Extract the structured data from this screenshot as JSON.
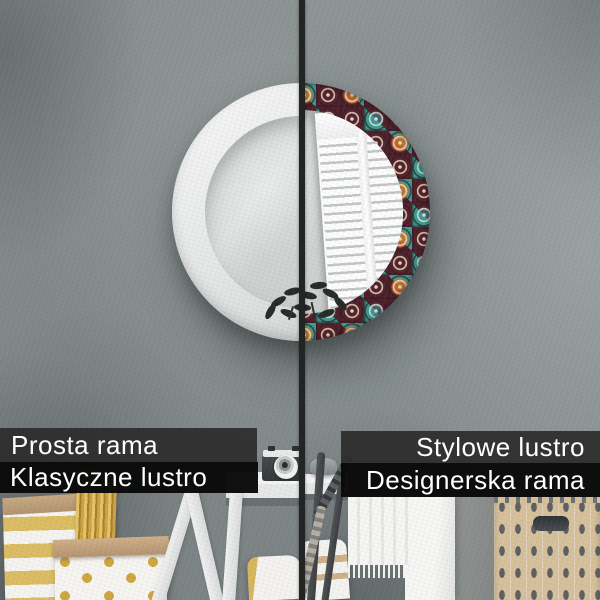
{
  "image": {
    "kind": "product-comparison-photo",
    "subject": "round decorative wall mirror, plain frame vs designer mosaic frame",
    "width": 600,
    "height": 600
  },
  "captions": {
    "left": {
      "line1": "Prosta rama",
      "line2": "Klasyczne lustro"
    },
    "right": {
      "line1": "Stylowe lustro",
      "line2": "Designerska rama"
    }
  },
  "colors": {
    "caption_bar_dark": "#2c2c2c",
    "caption_bar_black": "#090909",
    "caption_text": "#ffffff",
    "divider": "#232524",
    "wall_gray": "#868d8d",
    "frame_white": "#e9ebea",
    "mosaic_teal": "#2f9e94",
    "mosaic_maroon": "#54222c",
    "mosaic_gold": "#cf9a30",
    "mosaic_cream": "#e8dfc4",
    "mosaic_orange": "#ce702c",
    "gold_accent": "#d8b75e"
  }
}
